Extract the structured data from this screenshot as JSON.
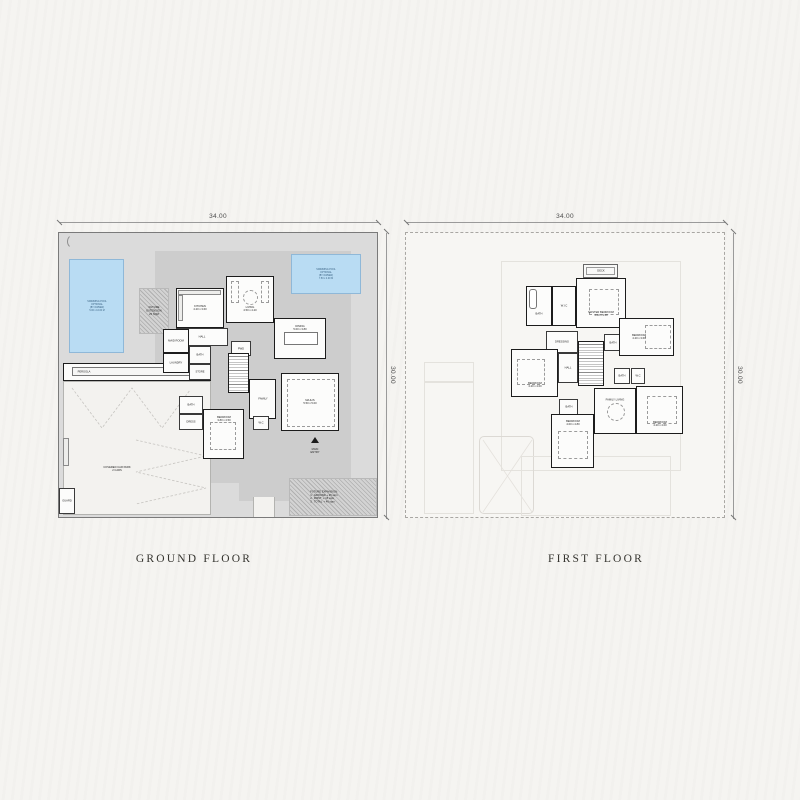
{
  "plans": {
    "ground": {
      "title": "GROUND FLOOR",
      "dim_top": "34.00",
      "dim_side": "30.00",
      "pool_left": "SWIMMING POOL\nOPTIONAL\n(BY OWNER)\n5.00 x 10.00 M",
      "pool_right": "SWIMMING POOL\nOPTIONAL\n(BY OWNER)\n7.50 x 4.00 M",
      "future_ext": "FUTURE\nEXTENSION\n25 SQM",
      "pergola": "PERGOLA",
      "carpark": "COVERED CAR PARK\n2 CARS",
      "guard": "GUARD",
      "entry": "MAIN\nENTRY",
      "notes": "FUTURE EXPANSION:\n1.  GROUND + 25 sqm\n2.  FIRST  + 15 sqm\n3.  TOTAL  + 40 sqm",
      "rooms": [
        {
          "label": "KITCHEN\n4.20 x 3.60"
        },
        {
          "label": "LIVING\n4.50 x 4.20"
        },
        {
          "label": "DINING\n5.00 x 3.80"
        },
        {
          "label": "HALL"
        },
        {
          "label": "PWD"
        },
        {
          "label": "MAID ROOM"
        },
        {
          "label": "LAUNDRY"
        },
        {
          "label": "BATH"
        },
        {
          "label": "STORE"
        },
        {
          "label": "FAMILY"
        },
        {
          "label": "MAJLIS\n5.50 x 5.00"
        },
        {
          "label": "W.C"
        },
        {
          "label": "BEDROOM\n3.80 x 4.50"
        },
        {
          "label": "BATH"
        },
        {
          "label": "DRESS"
        }
      ]
    },
    "first": {
      "title": "FIRST FLOOR",
      "dim_top": "34.00",
      "dim_side": "30.00",
      "rooms": [
        {
          "label": "DECK"
        },
        {
          "label": "MASTER BEDROOM\n4.80 x 4.50"
        },
        {
          "label": "BATH"
        },
        {
          "label": "W.I.C"
        },
        {
          "label": "DRESSING"
        },
        {
          "label": "BATH"
        },
        {
          "label": "BEDROOM\n4.20 x 3.60"
        },
        {
          "label": "HALL"
        },
        {
          "label": "BEDROOM\n4.20 x 4.00"
        },
        {
          "label": "BATH"
        },
        {
          "label": "BEDROOM\n4.00 x 4.80"
        },
        {
          "label": "FAMILY LIVING"
        },
        {
          "label": "BEDROOM\n4.20 x 4.00"
        },
        {
          "label": "BATH"
        },
        {
          "label": "W.C"
        }
      ]
    }
  }
}
